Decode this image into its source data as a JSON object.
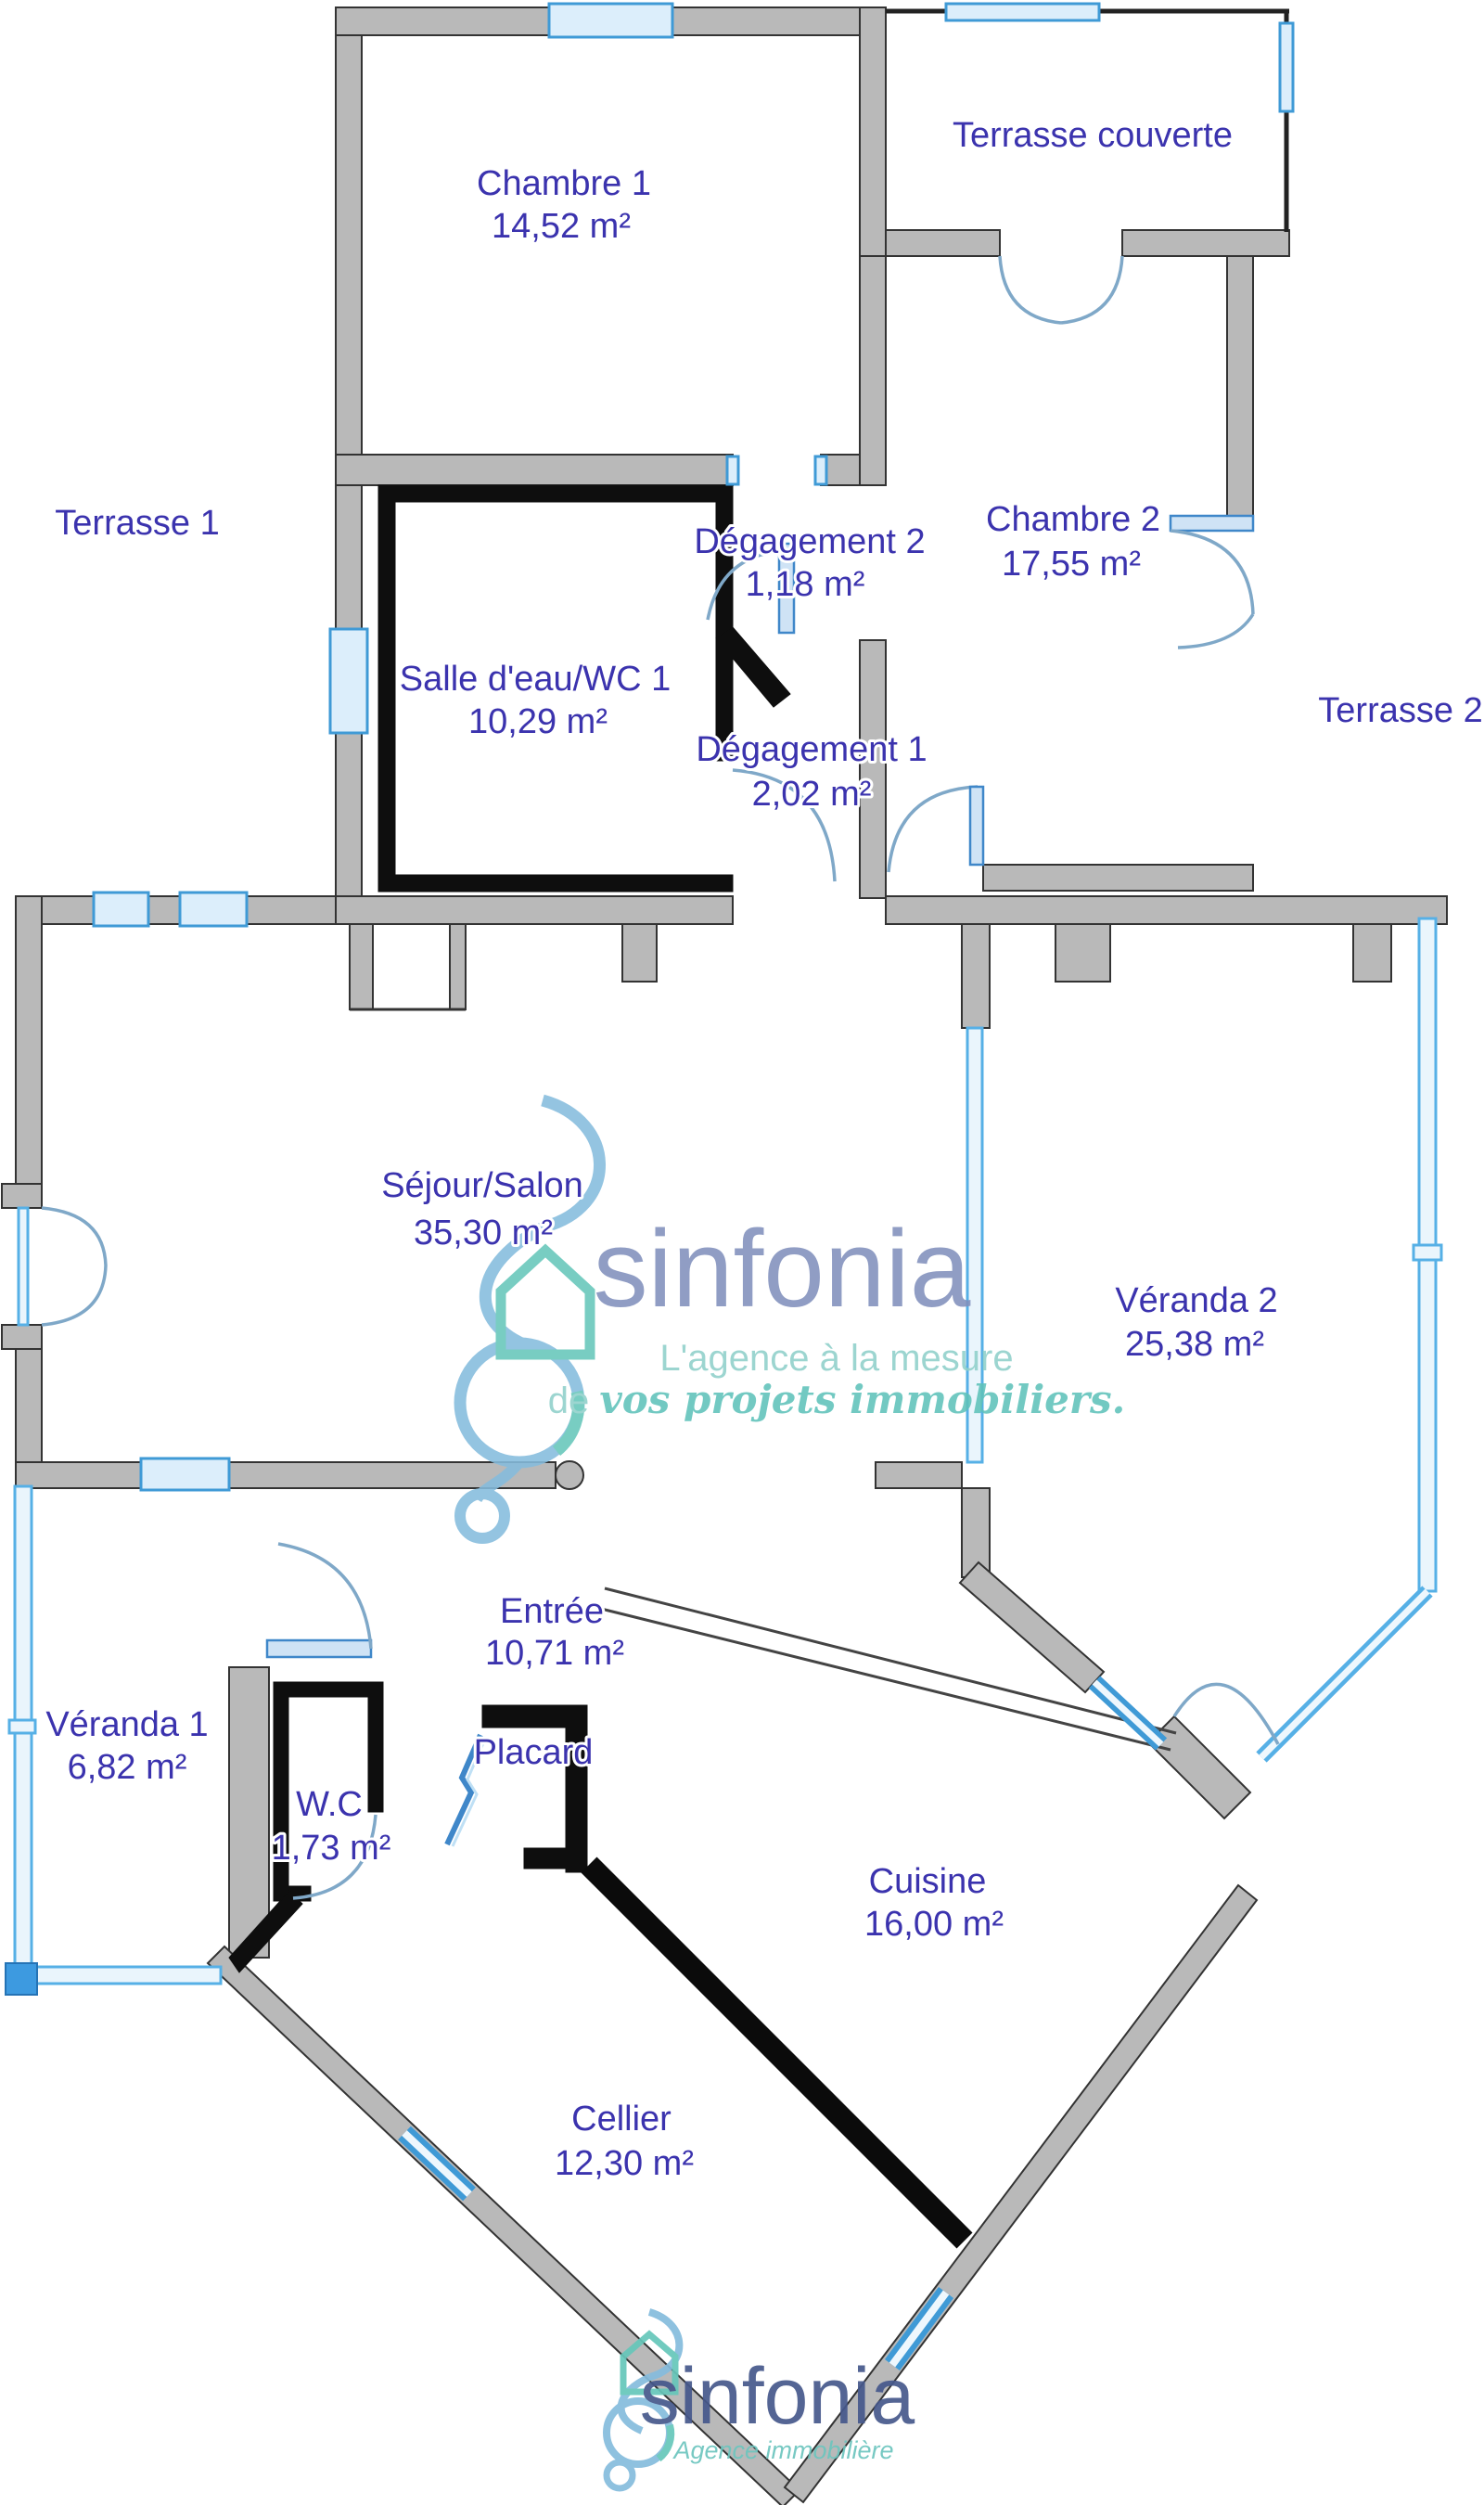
{
  "plan": {
    "rooms": [
      {
        "name": "Chambre 1",
        "area": "14,52 m²"
      },
      {
        "name": "Terrasse couverte"
      },
      {
        "name": "Chambre 2",
        "area": "17,55 m²"
      },
      {
        "name": "Terrasse 1"
      },
      {
        "name": "Terrasse 2"
      },
      {
        "name": "Salle d'eau/WC 1",
        "area": "10,29 m²"
      },
      {
        "name": "Dégagement 2",
        "area": "1,18 m²"
      },
      {
        "name": "Dégagement 1",
        "area": "2,02 m²"
      },
      {
        "name": "Séjour/Salon",
        "area": "35,30 m²"
      },
      {
        "name": "Véranda 2",
        "area": "25,38 m²"
      },
      {
        "name": "Entrée",
        "area": "10,71 m²"
      },
      {
        "name": "Véranda 1",
        "area": "6,82 m²"
      },
      {
        "name": "W.C",
        "area": "1,73 m²"
      },
      {
        "name": "Placard"
      },
      {
        "name": "Cuisine",
        "area": "16,00 m²"
      },
      {
        "name": "Cellier",
        "area": "12,30 m²"
      }
    ],
    "colors": {
      "label_text": "#3b33ae",
      "wall_gray": "#b9b9b9",
      "wall_dark": "#0e0e0e",
      "window_blue": "#3f9ad6",
      "glass_fill": "#eaf5fc"
    }
  },
  "watermark_center": {
    "brand": "sinfonia",
    "tagline_line1": "L'agence à la mesure",
    "tagline_line2_prefix": "de ",
    "tagline_line2_script": "vos projets immobiliers.",
    "brand_color": "#8190bd",
    "tagline_color": "#7ecac4"
  },
  "watermark_footer": {
    "brand": "sinfonia",
    "tagline": "Agence immobilière",
    "brand_color": "#46588c",
    "tagline_color": "#6cc5be"
  }
}
